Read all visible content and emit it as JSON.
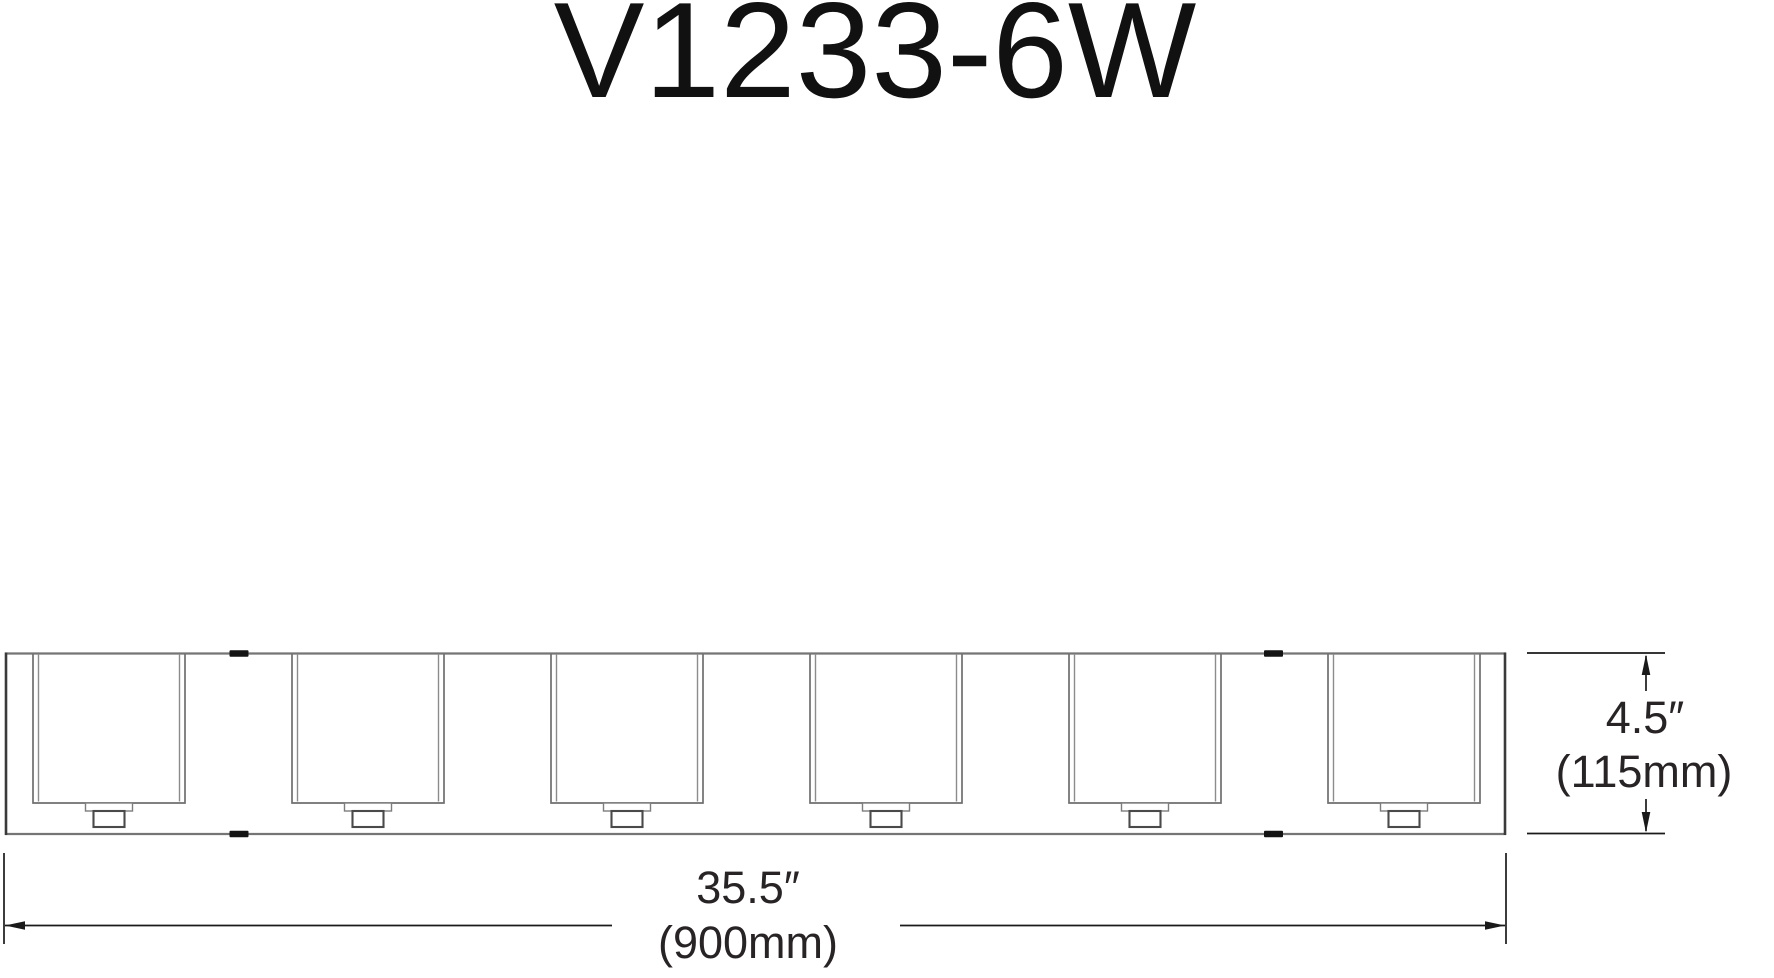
{
  "title": "V1233-6W",
  "drawing": {
    "description": "Front elevation line drawing of a 6-light bath vanity fixture with square glass shades and dimension callouts",
    "shade_count": 6,
    "dimensions": {
      "width": {
        "imperial": "35.5″",
        "metric": "(900mm)"
      },
      "height": {
        "imperial": "4.5″",
        "metric": "(115mm)"
      }
    }
  },
  "colors": {
    "background": "#ffffff",
    "fixture_line_gray": "#757575",
    "fixture_edge_dark": "#3a3a3a",
    "shade_line_gray": "#6f6f6f",
    "shade_inner_gray": "#8c8c8c",
    "socket_outline_dark": "#4a4a4a",
    "socket_collar_gray": "#7d7d7d",
    "mounting_tick_black": "#141414",
    "dimension_line": "#1a1a1a",
    "label_text": "#282425"
  }
}
